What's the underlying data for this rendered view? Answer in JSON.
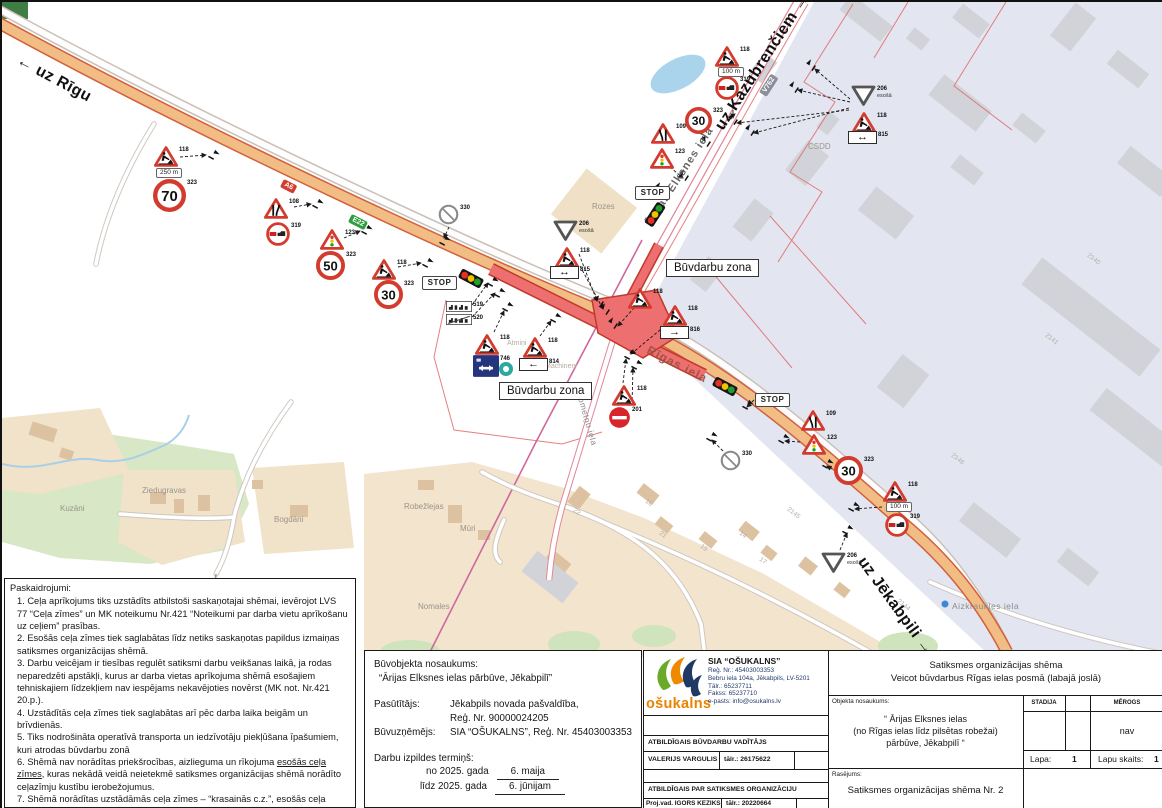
{
  "map": {
    "direction_labels": [
      {
        "t": "← uz Rīgu",
        "x": 20,
        "y": 50,
        "r": 28,
        "c": "dir",
        "n": "direction-label-riga"
      },
      {
        "t": "uz Kazubrenčiem →",
        "x": 710,
        "y": 122,
        "r": -57,
        "c": "dir",
        "n": "direction-label-kazubrenciem"
      },
      {
        "t": "uz Jēkabpili →",
        "x": 866,
        "y": 552,
        "r": 54,
        "c": "dir",
        "n": "direction-label-jekabpils"
      }
    ],
    "street_labels": [
      {
        "t": "Ārijas Elksnes iela",
        "x": 641,
        "y": 220,
        "r": -57,
        "c": "street",
        "n": "street-label-arijas-elksnes"
      },
      {
        "t": "Rīgas iela",
        "x": 649,
        "y": 341,
        "r": 27,
        "c": "streetred",
        "n": "street-label-rigas-iela"
      },
      {
        "t": "Nometņu iela",
        "x": 582,
        "y": 388,
        "r": 74,
        "c": "streetsm",
        "n": "street-label-nometnu-iela"
      },
      {
        "t": "Aizkraukles iela",
        "x": 950,
        "y": 599,
        "r": 0,
        "c": "streetsm",
        "n": "street-label-aizkraukles-iela"
      }
    ],
    "place_labels": [
      {
        "t": "Rozes",
        "x": 590,
        "y": 200,
        "r": 0,
        "c": "place"
      },
      {
        "t": "Kuzāni",
        "x": 58,
        "y": 502,
        "r": 0,
        "c": "place"
      },
      {
        "t": "Ziedugravas",
        "x": 140,
        "y": 484,
        "r": 0,
        "c": "place"
      },
      {
        "t": "Bogdāni",
        "x": 272,
        "y": 513,
        "r": 0,
        "c": "place"
      },
      {
        "t": "Robežlejas",
        "x": 402,
        "y": 500,
        "r": 0,
        "c": "place"
      },
      {
        "t": "Mūri",
        "x": 458,
        "y": 522,
        "r": 0,
        "c": "place"
      },
      {
        "t": "Nomales",
        "x": 416,
        "y": 600,
        "r": 0,
        "c": "place"
      },
      {
        "t": "CSDD",
        "x": 806,
        "y": 140,
        "r": 0,
        "c": "place"
      },
      {
        "t": "Machinery",
        "x": 543,
        "y": 361,
        "r": 0,
        "c": "tiny"
      },
      {
        "t": "Atmiņi",
        "x": 505,
        "y": 338,
        "r": 0,
        "c": "tiny"
      }
    ],
    "road_badges": [
      {
        "t": "A6",
        "x": 282,
        "y": 177,
        "r": 27,
        "c": "badge badge-red",
        "n": "road-badge-a6"
      },
      {
        "t": "E22",
        "x": 350,
        "y": 212,
        "r": 27,
        "c": "badge badge-green",
        "n": "road-badge-e22"
      },
      {
        "t": "V762",
        "x": 757,
        "y": 90,
        "r": -57,
        "c": "badge badge-gray",
        "n": "road-badge-v762"
      }
    ],
    "zone_labels": [
      {
        "t": "Būvdarbu zona",
        "x": 664,
        "y": 257,
        "r": 0,
        "c": "zonebox",
        "n": "construction-zone-label"
      },
      {
        "t": "Būvdarbu zona",
        "x": 497,
        "y": 380,
        "r": 0,
        "c": "zonebox",
        "n": "construction-zone-label"
      }
    ],
    "parcel_numbers": [
      {
        "t": "2146",
        "x": 952,
        "y": 450,
        "r": 38,
        "c": "num"
      },
      {
        "t": "2141",
        "x": 1046,
        "y": 330,
        "r": 38,
        "c": "num"
      },
      {
        "t": "2140",
        "x": 1088,
        "y": 250,
        "r": 38,
        "c": "num"
      },
      {
        "t": "2144",
        "x": 898,
        "y": 596,
        "r": 38,
        "c": "num"
      },
      {
        "t": "2145",
        "x": 788,
        "y": 504,
        "r": 38,
        "c": "num"
      },
      {
        "t": "22",
        "x": 574,
        "y": 505,
        "r": 38,
        "c": "num"
      },
      {
        "t": "16",
        "x": 646,
        "y": 496,
        "r": 38,
        "c": "num"
      },
      {
        "t": "21",
        "x": 660,
        "y": 528,
        "r": 38,
        "c": "num"
      },
      {
        "t": "19",
        "x": 701,
        "y": 541,
        "r": 38,
        "c": "num"
      },
      {
        "t": "14",
        "x": 740,
        "y": 528,
        "r": 38,
        "c": "num"
      },
      {
        "t": "17",
        "x": 760,
        "y": 554,
        "r": 38,
        "c": "num"
      }
    ],
    "signs": [
      {
        "t": "works",
        "x": 152,
        "y": 144,
        "lb": "118"
      },
      {
        "t": "dist",
        "x": 154,
        "y": 166,
        "v": "250 m"
      },
      {
        "t": "speed",
        "x": 151,
        "y": 177,
        "v": "70",
        "lb": "323",
        "s": 33
      },
      {
        "t": "narrow",
        "x": 262,
        "y": 196,
        "d": "r",
        "lb": "108"
      },
      {
        "t": "ovr",
        "x": 264,
        "y": 220,
        "lb": "319"
      },
      {
        "t": "sigtri",
        "x": 318,
        "y": 227,
        "lb": "123"
      },
      {
        "t": "speed",
        "x": 314,
        "y": 249,
        "v": "50",
        "lb": "323",
        "s": 29
      },
      {
        "t": "works",
        "x": 370,
        "y": 257,
        "lb": "118"
      },
      {
        "t": "speed",
        "x": 372,
        "y": 278,
        "v": "30",
        "lb": "323",
        "s": 29
      },
      {
        "t": "stopp",
        "x": 420,
        "y": 274
      },
      {
        "t": "tl",
        "x": 456,
        "y": 271,
        "r": 28
      },
      {
        "t": "crossed",
        "x": 436,
        "y": 202,
        "lb": "330"
      },
      {
        "t": "town",
        "x": 444,
        "y": 299,
        "lb": "519"
      },
      {
        "t": "town",
        "x": 444,
        "y": 312,
        "lb": "520",
        "v2": true
      },
      {
        "t": "givegray",
        "x": 551,
        "y": 218,
        "lb": "206",
        "sub": "esošā"
      },
      {
        "t": "works",
        "x": 553,
        "y": 245,
        "lb": "118"
      },
      {
        "t": "parrow",
        "x": 548,
        "y": 264,
        "g": "↔",
        "lb": "815"
      },
      {
        "t": "works",
        "x": 473,
        "y": 332,
        "lb": "118"
      },
      {
        "t": "p746",
        "x": 471,
        "y": 353,
        "lb": "746"
      },
      {
        "t": "works",
        "x": 521,
        "y": 335,
        "lb": "118"
      },
      {
        "t": "parrow",
        "x": 517,
        "y": 356,
        "g": "←",
        "lb": "814"
      },
      {
        "t": "works",
        "x": 610,
        "y": 383,
        "lb": "118"
      },
      {
        "t": "noentry",
        "x": 606,
        "y": 404,
        "lb": "201"
      },
      {
        "t": "works",
        "x": 626,
        "y": 286,
        "lb": "118"
      },
      {
        "t": "works",
        "x": 661,
        "y": 303,
        "lb": "118"
      },
      {
        "t": "parrow",
        "x": 658,
        "y": 324,
        "g": "→",
        "lb": "816"
      },
      {
        "t": "tl",
        "x": 710,
        "y": 379,
        "r": 28
      },
      {
        "t": "stopp",
        "x": 753,
        "y": 391
      },
      {
        "t": "narrow",
        "x": 799,
        "y": 408,
        "d": "l",
        "lb": "109"
      },
      {
        "t": "sigtri",
        "x": 800,
        "y": 432,
        "lb": "123"
      },
      {
        "t": "speed",
        "x": 832,
        "y": 454,
        "v": "30",
        "lb": "323",
        "s": 29
      },
      {
        "t": "crossed",
        "x": 718,
        "y": 448,
        "lb": "330"
      },
      {
        "t": "works",
        "x": 881,
        "y": 479,
        "lb": "118"
      },
      {
        "t": "dist",
        "x": 884,
        "y": 500,
        "v": "100 m"
      },
      {
        "t": "ovr",
        "x": 883,
        "y": 511,
        "lb": "319"
      },
      {
        "t": "givegray",
        "x": 819,
        "y": 550,
        "lb": "206",
        "sub": "esošā"
      },
      {
        "t": "stopp",
        "x": 633,
        "y": 184
      },
      {
        "t": "tl",
        "x": 640,
        "y": 207,
        "r": -57
      },
      {
        "t": "narrow",
        "x": 649,
        "y": 121,
        "d": "l",
        "lb": "109"
      },
      {
        "t": "sigtri",
        "x": 648,
        "y": 146,
        "lb": "123"
      },
      {
        "t": "speed",
        "x": 683,
        "y": 105,
        "v": "30",
        "lb": "323",
        "s": 27
      },
      {
        "t": "works",
        "x": 713,
        "y": 44,
        "lb": "118"
      },
      {
        "t": "dist",
        "x": 716,
        "y": 65,
        "v": "100 m"
      },
      {
        "t": "ovr",
        "x": 713,
        "y": 74,
        "lb": "319"
      },
      {
        "t": "givegray",
        "x": 849,
        "y": 83,
        "lb": "206",
        "sub": "esošā"
      },
      {
        "t": "works",
        "x": 850,
        "y": 110,
        "lb": "118"
      },
      {
        "t": "parrow",
        "x": 846,
        "y": 129,
        "g": "↔",
        "lb": "815"
      }
    ],
    "markers": [
      [
        210,
        154,
        28
      ],
      [
        314,
        203,
        28
      ],
      [
        363,
        229,
        28
      ],
      [
        424,
        262,
        28
      ],
      [
        441,
        240,
        28
      ],
      [
        489,
        281,
        28
      ],
      [
        496,
        292,
        28
      ],
      [
        598,
        301,
        -57
      ],
      [
        604,
        309,
        -57
      ],
      [
        504,
        306,
        28
      ],
      [
        552,
        317,
        28
      ],
      [
        612,
        323,
        -57
      ],
      [
        626,
        354,
        28
      ],
      [
        633,
        364,
        28
      ],
      [
        744,
        404,
        28
      ],
      [
        780,
        438,
        28
      ],
      [
        824,
        463,
        28
      ],
      [
        850,
        506,
        28
      ],
      [
        844,
        529,
        28
      ],
      [
        708,
        436,
        28
      ],
      [
        659,
        188,
        -57
      ],
      [
        683,
        175,
        -57
      ],
      [
        705,
        141,
        -57
      ],
      [
        732,
        119,
        -57
      ],
      [
        749,
        130,
        -57
      ],
      [
        793,
        87,
        -57
      ],
      [
        810,
        65,
        -57
      ]
    ],
    "arrows": [
      [
        178,
        155,
        204,
        153
      ],
      [
        292,
        205,
        309,
        202
      ],
      [
        342,
        236,
        358,
        229
      ],
      [
        396,
        265,
        419,
        261
      ],
      [
        447,
        225,
        442,
        236
      ],
      [
        470,
        303,
        486,
        281
      ],
      [
        470,
        315,
        493,
        291
      ],
      [
        577,
        252,
        595,
        299
      ],
      [
        578,
        264,
        601,
        307
      ],
      [
        492,
        330,
        502,
        309
      ],
      [
        538,
        334,
        549,
        319
      ],
      [
        621,
        381,
        624,
        357
      ],
      [
        630,
        403,
        631,
        366
      ],
      [
        639,
        298,
        616,
        324
      ],
      [
        670,
        318,
        629,
        352
      ],
      [
        752,
        398,
        745,
        405
      ],
      [
        798,
        440,
        783,
        439
      ],
      [
        880,
        505,
        853,
        507
      ],
      [
        838,
        548,
        845,
        531
      ],
      [
        721,
        449,
        710,
        438
      ],
      [
        830,
        467,
        825,
        464
      ],
      [
        651,
        196,
        658,
        190
      ],
      [
        668,
        165,
        681,
        176
      ],
      [
        698,
        130,
        703,
        139
      ],
      [
        731,
        98,
        731,
        116
      ],
      [
        848,
        97,
        813,
        67
      ],
      [
        848,
        100,
        796,
        88
      ],
      [
        847,
        106,
        752,
        131
      ],
      [
        847,
        108,
        735,
        121
      ]
    ]
  },
  "notes": {
    "title": "Paskaidrojumi:",
    "items": [
      "1. Ceļa aprīkojums tiks uzstādīts atbilstoši saskaņotajai shēmai, ievērojot LVS 77 “Ceļa zīmes” un MK noteikumu Nr.421 “Noteikumi par darba vietu aprīkošanu uz ceļiem” prasības.",
      "2. Esošās ceļa zīmes tiek saglabātas līdz netiks saskaņotas papildus izmaiņas satiksmes organizācijas shēmā.",
      "3. Darbu veicējam ir tiesības regulēt satiksmi darbu veikšanas laikā, ja rodas neparedzēti apstākļi, kurus ar darba vietas aprīkojuma shēmā esošajiem tehniskajiem līdzekļiem nav iespējams nekavējoties novērst (MK not. Nr.421 20.p.).",
      "4. Uzstādītās ceļa zīmes tiek saglabātas arī pēc darba laika beigām un brīvdienās.",
      "5. Tiks nodrošināta operatīvā transporta un iedzīvotāju piekļūšana īpašumiem, kuri atrodas būvdarbu zonā"
    ],
    "item6_pre": "6. Shēmā nav norādītas priekšrocības, aizlieguma un rīkojuma ",
    "item6_underlined": "esošās ceļa zīmes",
    "item6_post": ", kuras nekādā veidā neietekmē satiksmes organizācijas shēmā norādīto ceļazīmju kustību ierobežojumus.",
    "item7": "7. Shēmā norādītas uzstādāmās ceļa zīmes – “krasainās c.z.”, esošās ceļa zīmes – “melnbaltas c.z.”"
  },
  "project": {
    "title_label": "Būvobjekta nosaukums:",
    "title_value": "“Ārijas Elksnes ielas pārbūve, Jēkabpilī”",
    "client_label": "Pasūtītājs:",
    "client_value1": "Jēkabpils novada pašvaldība,",
    "client_value2": "Reģ. Nr. 90000024205",
    "contractor_label": "Būvuzņēmējs:",
    "contractor_value": "SIA “OŠUKALNS”, Reģ. Nr. 45403003353",
    "term_label": "Darbu izpildes termiņš:",
    "term_from_label": "no 2025. gada",
    "term_from_value": "6. maija",
    "term_to_label": "līdz 2025. gada",
    "term_to_value": "6. jūnijam"
  },
  "titleblock": {
    "logo_text": "ošukalns",
    "company_name": "SIA “OŠUKALNS”",
    "company_reg": "Reģ. Nr.: 45403003353",
    "company_addr": "Bebru iela 104a, Jēkabpils, LV-5201",
    "company_phone": "Tālr.: 65237711",
    "company_fax": "Fakss: 65237710",
    "company_email": "e-pasts: info@osukalns.lv",
    "resp_build_header": "ATBILDĪGAIS BŪVDARBU VADĪTĀJS",
    "resp_build_name": "VALERIJS VARGULIS",
    "resp_build_phone": "tālr.: 26175622",
    "resp_traffic_header": "ATBILDĪGAIS PAR SATIKSMES ORGANIZĀCIJU",
    "resp_traffic_name": "Proj.vad. IGORS KEZIKS",
    "resp_traffic_phone": "tālr.: 20220664",
    "scheme_title1": "Satiksmes organizācijas shēma",
    "scheme_title2": "Veicot būvdarbus Rīgas ielas posmā (labajā joslā)",
    "object_label": "Objekta nosaukums:",
    "object_line1": "“ Ārijas Elksnes ielas",
    "object_line2": "(no Rīgas ielas līdz pilsētas robežai)",
    "object_line3": "pārbūve, Jēkabpilī “",
    "stadija_label": "STADIJA",
    "merogs_label": "MĒROGS",
    "merogs_value": "nav",
    "lapa_label": "Lapa:",
    "lapa_value": "1",
    "lapu_label": "Lapu skaits:",
    "lapu_value": "1",
    "rasejums_label": "Rasējums:",
    "rasejums_value": "Satiksmes organizācijas shēma Nr. 2"
  },
  "colors": {
    "road_fill": "#f2bd85",
    "road_edge": "#d2603c",
    "construction_red": "#ee6f6f",
    "construction_edge": "#c0392b",
    "industrial_zone": "#e3e6f1",
    "sign_red": "#d23b2e",
    "logo_orange": "#e98300"
  }
}
